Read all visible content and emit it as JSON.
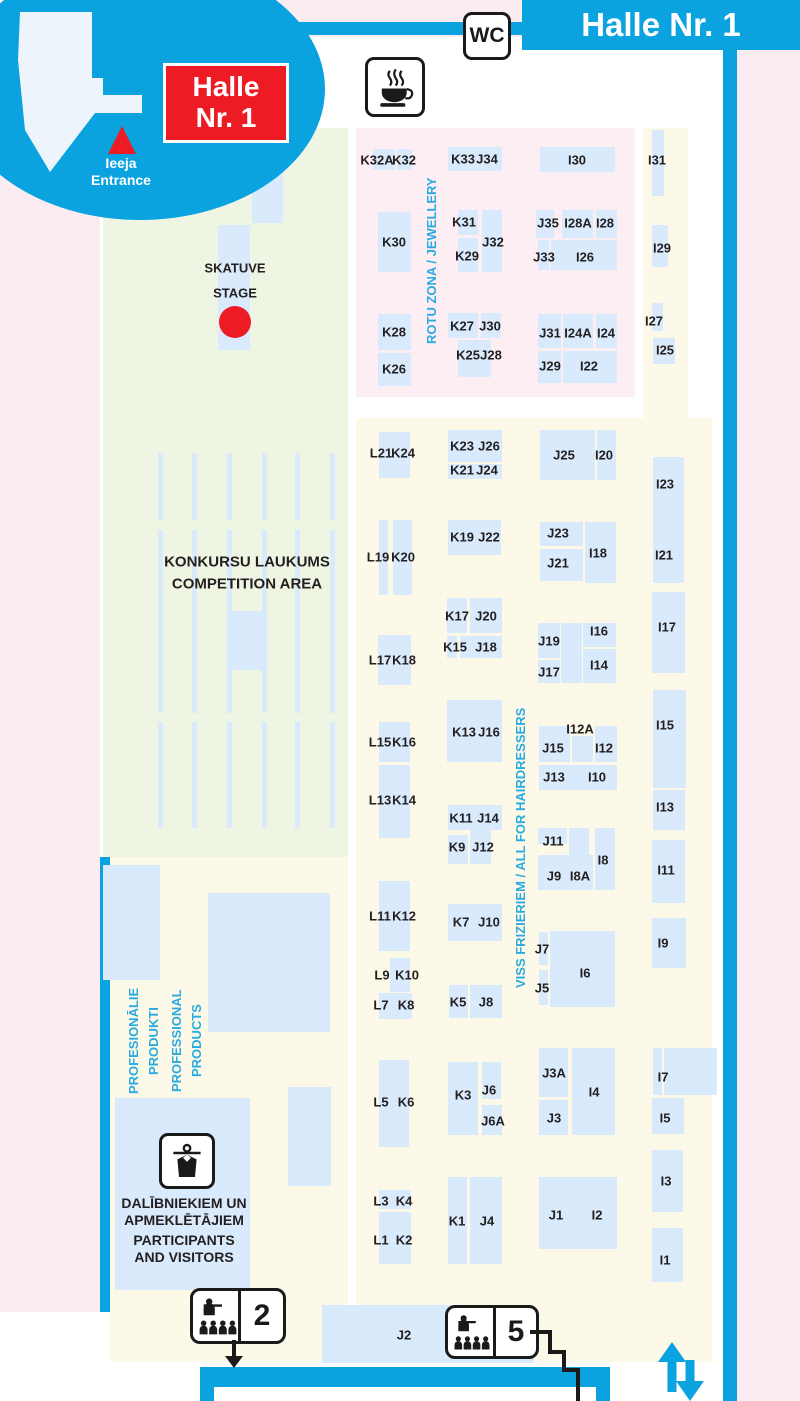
{
  "header": {
    "title": "Halle Nr. 1",
    "wc": "WC"
  },
  "bubble": {
    "line1": "Halle",
    "line2": "Nr. 1",
    "entrance_lv": "Ieeja",
    "entrance_en": "Entrance"
  },
  "stage": {
    "lv": "SKATUVE",
    "en": "STAGE"
  },
  "competition": {
    "lv": "KONKURSU LAUKUMS",
    "en": "COMPETITION AREA"
  },
  "jewellery": {
    "label": "ROTU ZONA / JEWELLERY"
  },
  "hairdressers": {
    "label": "VISS FRIZIERIEM / ALL FOR HAIRDRESSERS"
  },
  "professional": {
    "l1": "PROFESIONĀLIE",
    "l2": "PRODUKTI",
    "l3": "PROFESSIONAL",
    "l4": "PRODUCTS"
  },
  "cloakroom": {
    "l1": "DALĪBNIEKIEM UN",
    "l2": "APMEKLĒTĀJIEM",
    "l3": "PARTICIPANTS",
    "l4": "AND VISITORS"
  },
  "exits": {
    "hall2": "2",
    "hall5": "5"
  },
  "colors": {
    "accent_blue": "#0ba3df",
    "booth_blue": "#d9eafc",
    "zone_pink": "#fceef3",
    "zone_yellow": "#fdf9e8",
    "zone_green": "#eff5e3",
    "cyan_text": "#29abe2",
    "red": "#ed1c24",
    "label_dark": "#231f20",
    "bg_pink": "#fbecf1"
  },
  "map": {
    "blocks": [
      [
        373,
        149,
        22,
        21
      ],
      [
        397,
        149,
        15,
        21
      ],
      [
        448,
        147,
        54,
        24
      ],
      [
        540,
        147,
        75,
        25
      ],
      [
        652,
        130,
        12,
        66
      ],
      [
        378,
        212,
        33,
        60
      ],
      [
        458,
        210,
        20,
        25
      ],
      [
        458,
        238,
        20,
        34
      ],
      [
        482,
        210,
        20,
        62
      ],
      [
        536,
        210,
        18,
        28
      ],
      [
        562,
        210,
        31,
        28
      ],
      [
        596,
        210,
        21,
        28
      ],
      [
        538,
        240,
        11,
        30
      ],
      [
        551,
        240,
        66,
        30
      ],
      [
        652,
        225,
        16,
        42
      ],
      [
        378,
        314,
        33,
        36
      ],
      [
        378,
        353,
        33,
        33
      ],
      [
        448,
        313,
        30,
        25
      ],
      [
        481,
        313,
        20,
        25
      ],
      [
        458,
        340,
        33,
        37
      ],
      [
        538,
        314,
        23,
        34
      ],
      [
        563,
        314,
        30,
        34
      ],
      [
        596,
        314,
        21,
        34
      ],
      [
        538,
        351,
        23,
        32
      ],
      [
        563,
        351,
        54,
        32
      ],
      [
        652,
        303,
        11,
        28
      ],
      [
        653,
        338,
        22,
        26
      ],
      [
        379,
        432,
        31,
        46
      ],
      [
        448,
        430,
        54,
        32
      ],
      [
        448,
        464,
        54,
        15
      ],
      [
        540,
        430,
        55,
        50
      ],
      [
        597,
        430,
        19,
        50
      ],
      [
        653,
        457,
        31,
        126
      ],
      [
        379,
        520,
        9,
        75
      ],
      [
        393,
        520,
        19,
        75
      ],
      [
        448,
        520,
        53,
        35
      ],
      [
        540,
        522,
        43,
        24
      ],
      [
        540,
        549,
        43,
        32
      ],
      [
        585,
        522,
        31,
        61
      ],
      [
        447,
        598,
        20,
        35
      ],
      [
        470,
        598,
        32,
        35
      ],
      [
        447,
        636,
        10,
        22
      ],
      [
        460,
        636,
        42,
        22
      ],
      [
        378,
        635,
        33,
        50
      ],
      [
        538,
        623,
        22,
        35
      ],
      [
        538,
        660,
        22,
        23
      ],
      [
        561,
        623,
        21,
        60
      ],
      [
        583,
        623,
        33,
        24
      ],
      [
        583,
        649,
        33,
        34
      ],
      [
        652,
        592,
        33,
        81
      ],
      [
        447,
        700,
        55,
        62
      ],
      [
        379,
        722,
        31,
        40
      ],
      [
        539,
        726,
        31,
        36
      ],
      [
        572,
        736,
        21,
        26
      ],
      [
        595,
        726,
        22,
        36
      ],
      [
        539,
        765,
        78,
        25
      ],
      [
        653,
        690,
        33,
        98
      ],
      [
        379,
        765,
        31,
        73
      ],
      [
        448,
        805,
        54,
        25
      ],
      [
        653,
        790,
        32,
        40
      ],
      [
        448,
        835,
        20,
        29
      ],
      [
        470,
        828,
        21,
        36
      ],
      [
        538,
        828,
        29,
        16
      ],
      [
        569,
        828,
        20,
        27
      ],
      [
        595,
        828,
        20,
        62
      ],
      [
        538,
        855,
        55,
        35
      ],
      [
        652,
        840,
        33,
        63
      ],
      [
        379,
        881,
        31,
        70
      ],
      [
        448,
        904,
        54,
        37
      ],
      [
        539,
        932,
        9,
        33
      ],
      [
        550,
        931,
        65,
        76
      ],
      [
        539,
        970,
        9,
        35
      ],
      [
        652,
        918,
        34,
        50
      ],
      [
        390,
        958,
        20,
        34
      ],
      [
        379,
        993,
        33,
        26
      ],
      [
        449,
        985,
        19,
        33
      ],
      [
        470,
        985,
        32,
        33
      ],
      [
        379,
        1060,
        30,
        87
      ],
      [
        448,
        1062,
        30,
        73
      ],
      [
        482,
        1062,
        19,
        37
      ],
      [
        482,
        1105,
        20,
        30
      ],
      [
        539,
        1048,
        29,
        49
      ],
      [
        539,
        1100,
        29,
        35
      ],
      [
        572,
        1048,
        43,
        87
      ],
      [
        653,
        1048,
        9,
        47
      ],
      [
        664,
        1048,
        53,
        47
      ],
      [
        652,
        1098,
        32,
        36
      ],
      [
        379,
        1190,
        32,
        19
      ],
      [
        379,
        1212,
        32,
        52
      ],
      [
        448,
        1177,
        19,
        87
      ],
      [
        470,
        1177,
        32,
        87
      ],
      [
        539,
        1177,
        78,
        72
      ],
      [
        652,
        1150,
        31,
        62
      ],
      [
        652,
        1228,
        31,
        54
      ],
      [
        322,
        1305,
        212,
        58
      ],
      [
        103,
        865,
        57,
        115
      ],
      [
        208,
        893,
        122,
        139
      ],
      [
        288,
        1087,
        43,
        99
      ],
      [
        115,
        1098,
        135,
        192
      ],
      [
        252,
        128,
        31,
        95
      ],
      [
        218,
        225,
        32,
        125
      ],
      [
        230,
        611,
        32,
        59
      ]
    ],
    "labels": [
      [
        "K32A",
        377,
        160
      ],
      [
        "K32",
        404,
        160
      ],
      [
        "K33",
        463,
        159
      ],
      [
        "J34",
        487,
        159
      ],
      [
        "I30",
        577,
        160
      ],
      [
        "I31",
        657,
        160
      ],
      [
        "K30",
        394,
        242
      ],
      [
        "K31",
        464,
        222
      ],
      [
        "K29",
        467,
        256
      ],
      [
        "J32",
        493,
        242
      ],
      [
        "J35",
        548,
        223
      ],
      [
        "I28A",
        578,
        223
      ],
      [
        "I28",
        605,
        223
      ],
      [
        "J33",
        544,
        257
      ],
      [
        "I26",
        585,
        257
      ],
      [
        "I29",
        662,
        248
      ],
      [
        "K28",
        394,
        332
      ],
      [
        "K26",
        394,
        369
      ],
      [
        "K27",
        462,
        326
      ],
      [
        "J30",
        490,
        326
      ],
      [
        "K25",
        468,
        355
      ],
      [
        "J28",
        491,
        355
      ],
      [
        "J31",
        550,
        333
      ],
      [
        "I24A",
        578,
        333
      ],
      [
        "I24",
        606,
        333
      ],
      [
        "J29",
        550,
        366
      ],
      [
        "I22",
        589,
        366
      ],
      [
        "I27",
        654,
        321
      ],
      [
        "I25",
        665,
        350
      ],
      [
        "L21",
        381,
        453
      ],
      [
        "K24",
        403,
        453
      ],
      [
        "K23",
        462,
        446
      ],
      [
        "J26",
        489,
        446
      ],
      [
        "K21",
        462,
        470
      ],
      [
        "J24",
        487,
        470
      ],
      [
        "J25",
        564,
        455
      ],
      [
        "I20",
        604,
        455
      ],
      [
        "I23",
        665,
        484
      ],
      [
        "L19",
        378,
        557
      ],
      [
        "K20",
        403,
        557
      ],
      [
        "K19",
        462,
        537
      ],
      [
        "J22",
        489,
        537
      ],
      [
        "J23",
        558,
        533
      ],
      [
        "J21",
        558,
        563
      ],
      [
        "I18",
        598,
        553
      ],
      [
        "I21",
        664,
        555
      ],
      [
        "K17",
        457,
        616
      ],
      [
        "J20",
        486,
        616
      ],
      [
        "K15",
        455,
        647
      ],
      [
        "J18",
        486,
        647
      ],
      [
        "L17",
        380,
        660
      ],
      [
        "K18",
        404,
        660
      ],
      [
        "J19",
        549,
        641
      ],
      [
        "J17",
        549,
        672
      ],
      [
        "I16",
        599,
        631
      ],
      [
        "I14",
        599,
        665
      ],
      [
        "I17",
        667,
        627
      ],
      [
        "L15",
        380,
        742
      ],
      [
        "K16",
        404,
        742
      ],
      [
        "K13",
        464,
        732
      ],
      [
        "J16",
        489,
        732
      ],
      [
        "I12A",
        580,
        729
      ],
      [
        "J15",
        553,
        748
      ],
      [
        "I12",
        604,
        748
      ],
      [
        "J13",
        554,
        777
      ],
      [
        "I10",
        597,
        777
      ],
      [
        "I15",
        665,
        725
      ],
      [
        "L13",
        380,
        800
      ],
      [
        "K14",
        404,
        800
      ],
      [
        "K11",
        461,
        818
      ],
      [
        "J14",
        488,
        818
      ],
      [
        "I13",
        665,
        807
      ],
      [
        "K9",
        457,
        847
      ],
      [
        "J12",
        483,
        847
      ],
      [
        "J11",
        553,
        841
      ],
      [
        "I8",
        603,
        860
      ],
      [
        "J9",
        554,
        876
      ],
      [
        "I8A",
        580,
        876
      ],
      [
        "I11",
        666,
        870
      ],
      [
        "L11",
        380,
        916
      ],
      [
        "K12",
        404,
        916
      ],
      [
        "K7",
        461,
        922
      ],
      [
        "J10",
        489,
        922
      ],
      [
        "J7",
        542,
        949
      ],
      [
        "I6",
        585,
        973
      ],
      [
        "J5",
        542,
        988
      ],
      [
        "I9",
        663,
        943
      ],
      [
        "L9",
        382,
        975
      ],
      [
        "K10",
        407,
        975
      ],
      [
        "L7",
        381,
        1005
      ],
      [
        "K8",
        406,
        1005
      ],
      [
        "K5",
        458,
        1002
      ],
      [
        "J8",
        486,
        1002
      ],
      [
        "L5",
        381,
        1102
      ],
      [
        "K6",
        406,
        1102
      ],
      [
        "K3",
        463,
        1095
      ],
      [
        "J6",
        489,
        1090
      ],
      [
        "J6A",
        493,
        1121
      ],
      [
        "J3A",
        554,
        1073
      ],
      [
        "I4",
        594,
        1092
      ],
      [
        "J3",
        554,
        1118
      ],
      [
        "I7",
        663,
        1077
      ],
      [
        "I5",
        665,
        1118
      ],
      [
        "L3",
        381,
        1201
      ],
      [
        "K4",
        404,
        1201
      ],
      [
        "L1",
        381,
        1240
      ],
      [
        "K2",
        404,
        1240
      ],
      [
        "K1",
        457,
        1221
      ],
      [
        "J4",
        487,
        1221
      ],
      [
        "J1",
        556,
        1215
      ],
      [
        "I2",
        597,
        1215
      ],
      [
        "I3",
        666,
        1181
      ],
      [
        "I1",
        665,
        1260
      ],
      [
        "J2",
        404,
        1335
      ]
    ],
    "competition_lines": {
      "xs": [
        158,
        192,
        227,
        262,
        295,
        330
      ],
      "segments": [
        [
          453,
          67
        ],
        [
          530,
          183
        ],
        [
          722,
          106
        ]
      ]
    }
  }
}
